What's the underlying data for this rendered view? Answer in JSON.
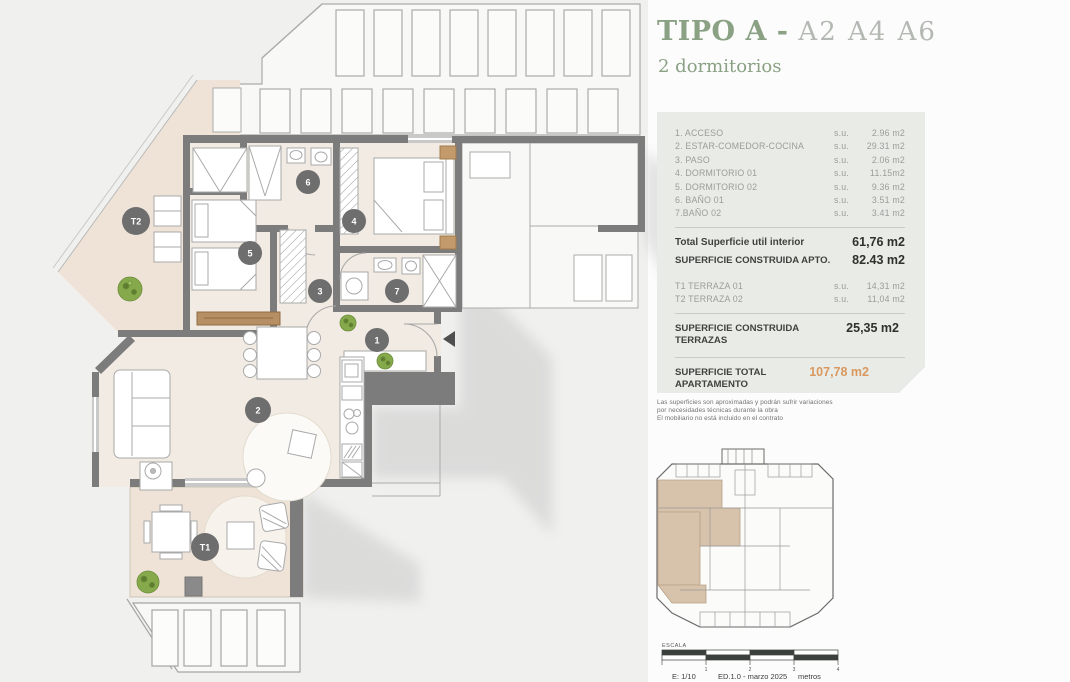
{
  "title": {
    "main": "TIPO A",
    "separator": " - ",
    "units": "A2 A4 A6",
    "subtitle": "2 dormitorios"
  },
  "areas": {
    "rooms": [
      {
        "label": "1. ACCESO",
        "su": "s.u.",
        "value": "2.96 m2"
      },
      {
        "label": "2. ESTAR-COMEDOR-COCINA",
        "su": "s.u.",
        "value": "29.31 m2"
      },
      {
        "label": "3. PASO",
        "su": "s.u.",
        "value": "2.06 m2"
      },
      {
        "label": "4. DORMITORIO 01",
        "su": "s.u.",
        "value": "11.15m2"
      },
      {
        "label": "5. DORMITORIO 02",
        "su": "s.u.",
        "value": "9.36 m2"
      },
      {
        "label": "6. BAÑO 01",
        "su": "s.u.",
        "value": "3.51 m2"
      },
      {
        "label": "7.BAÑO 02",
        "su": "s.u.",
        "value": "3.41 m2"
      }
    ],
    "total_util": {
      "label": "Total Superficie util interior",
      "value": "61,76 m2"
    },
    "construida_apto": {
      "label": "SUPERFICIE CONSTRUIDA APTO.",
      "value": "82.43 m2"
    },
    "terrazas": [
      {
        "label": "T1 TERRAZA 01",
        "su": "s.u.",
        "value": "14,31 m2"
      },
      {
        "label": "T2 TERRAZA 02",
        "su": "s.u.",
        "value": "11,04 m2"
      }
    ],
    "construida_terrazas": {
      "label": "SUPERFICIE CONSTRUIDA TERRAZAS",
      "value": "25,35 m2"
    },
    "total_apartamento": {
      "label": "SUPERFICIE TOTAL APARTAMENTO",
      "value": "107,78 m2"
    }
  },
  "disclaimer": {
    "line1": "Las superficies son aproximadas y podrán sufrir variaciones",
    "line2": "por necesidades técnicas durante la obra",
    "line3": "El mobiliario no está incluido en el contrato"
  },
  "floorplan": {
    "badges": [
      "1",
      "2",
      "3",
      "4",
      "5",
      "6",
      "7",
      "T1",
      "T2"
    ]
  },
  "keyplan": {
    "escala_label": "ESCALA",
    "scale": "E: 1/10",
    "edition": "ED.1.0 - marzo 2025",
    "units_label": "metros",
    "ticks": [
      "1",
      "2",
      "3",
      "4"
    ]
  },
  "colors": {
    "accent_green": "#8aa184",
    "accent_orange": "#d9985f",
    "panel_bg": "#e9ebe6",
    "wall": "#7c7c7c",
    "floor": "#f1ebe3",
    "terrace": "#eee3d6",
    "keyplan_highlight": "#d7c2ab"
  }
}
